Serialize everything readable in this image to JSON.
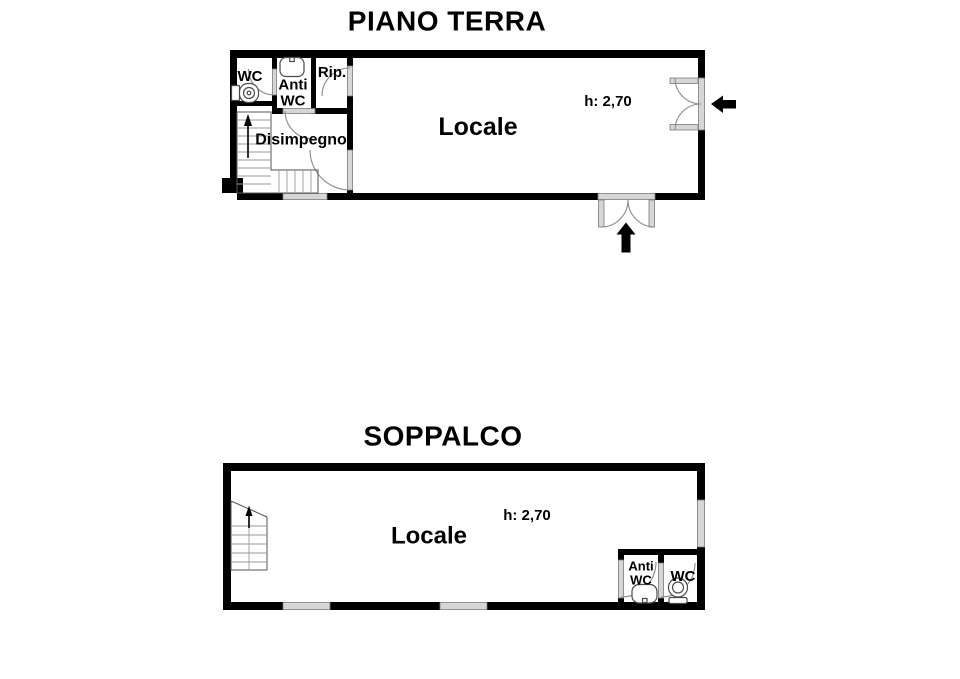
{
  "colors": {
    "wall": "#000000",
    "opening_fill": "#d6d6d6",
    "opening_border": "#7a7a7a",
    "door_swing_line": "#8a8a8a",
    "text": "#000000",
    "background": "#ffffff"
  },
  "floors": [
    {
      "title": "PIANO TERRA",
      "height_note": "h: 2,70",
      "rooms": {
        "wc": "WC",
        "anti_wc": "Anti WC",
        "rip": "Rip.",
        "disimpegno": "Disimpegno",
        "locale": "Locale"
      }
    },
    {
      "title": "SOPPALCO",
      "height_note": "h: 2,70",
      "rooms": {
        "locale": "Locale",
        "anti_wc": "Anti WC",
        "wc": "WC"
      }
    }
  ]
}
